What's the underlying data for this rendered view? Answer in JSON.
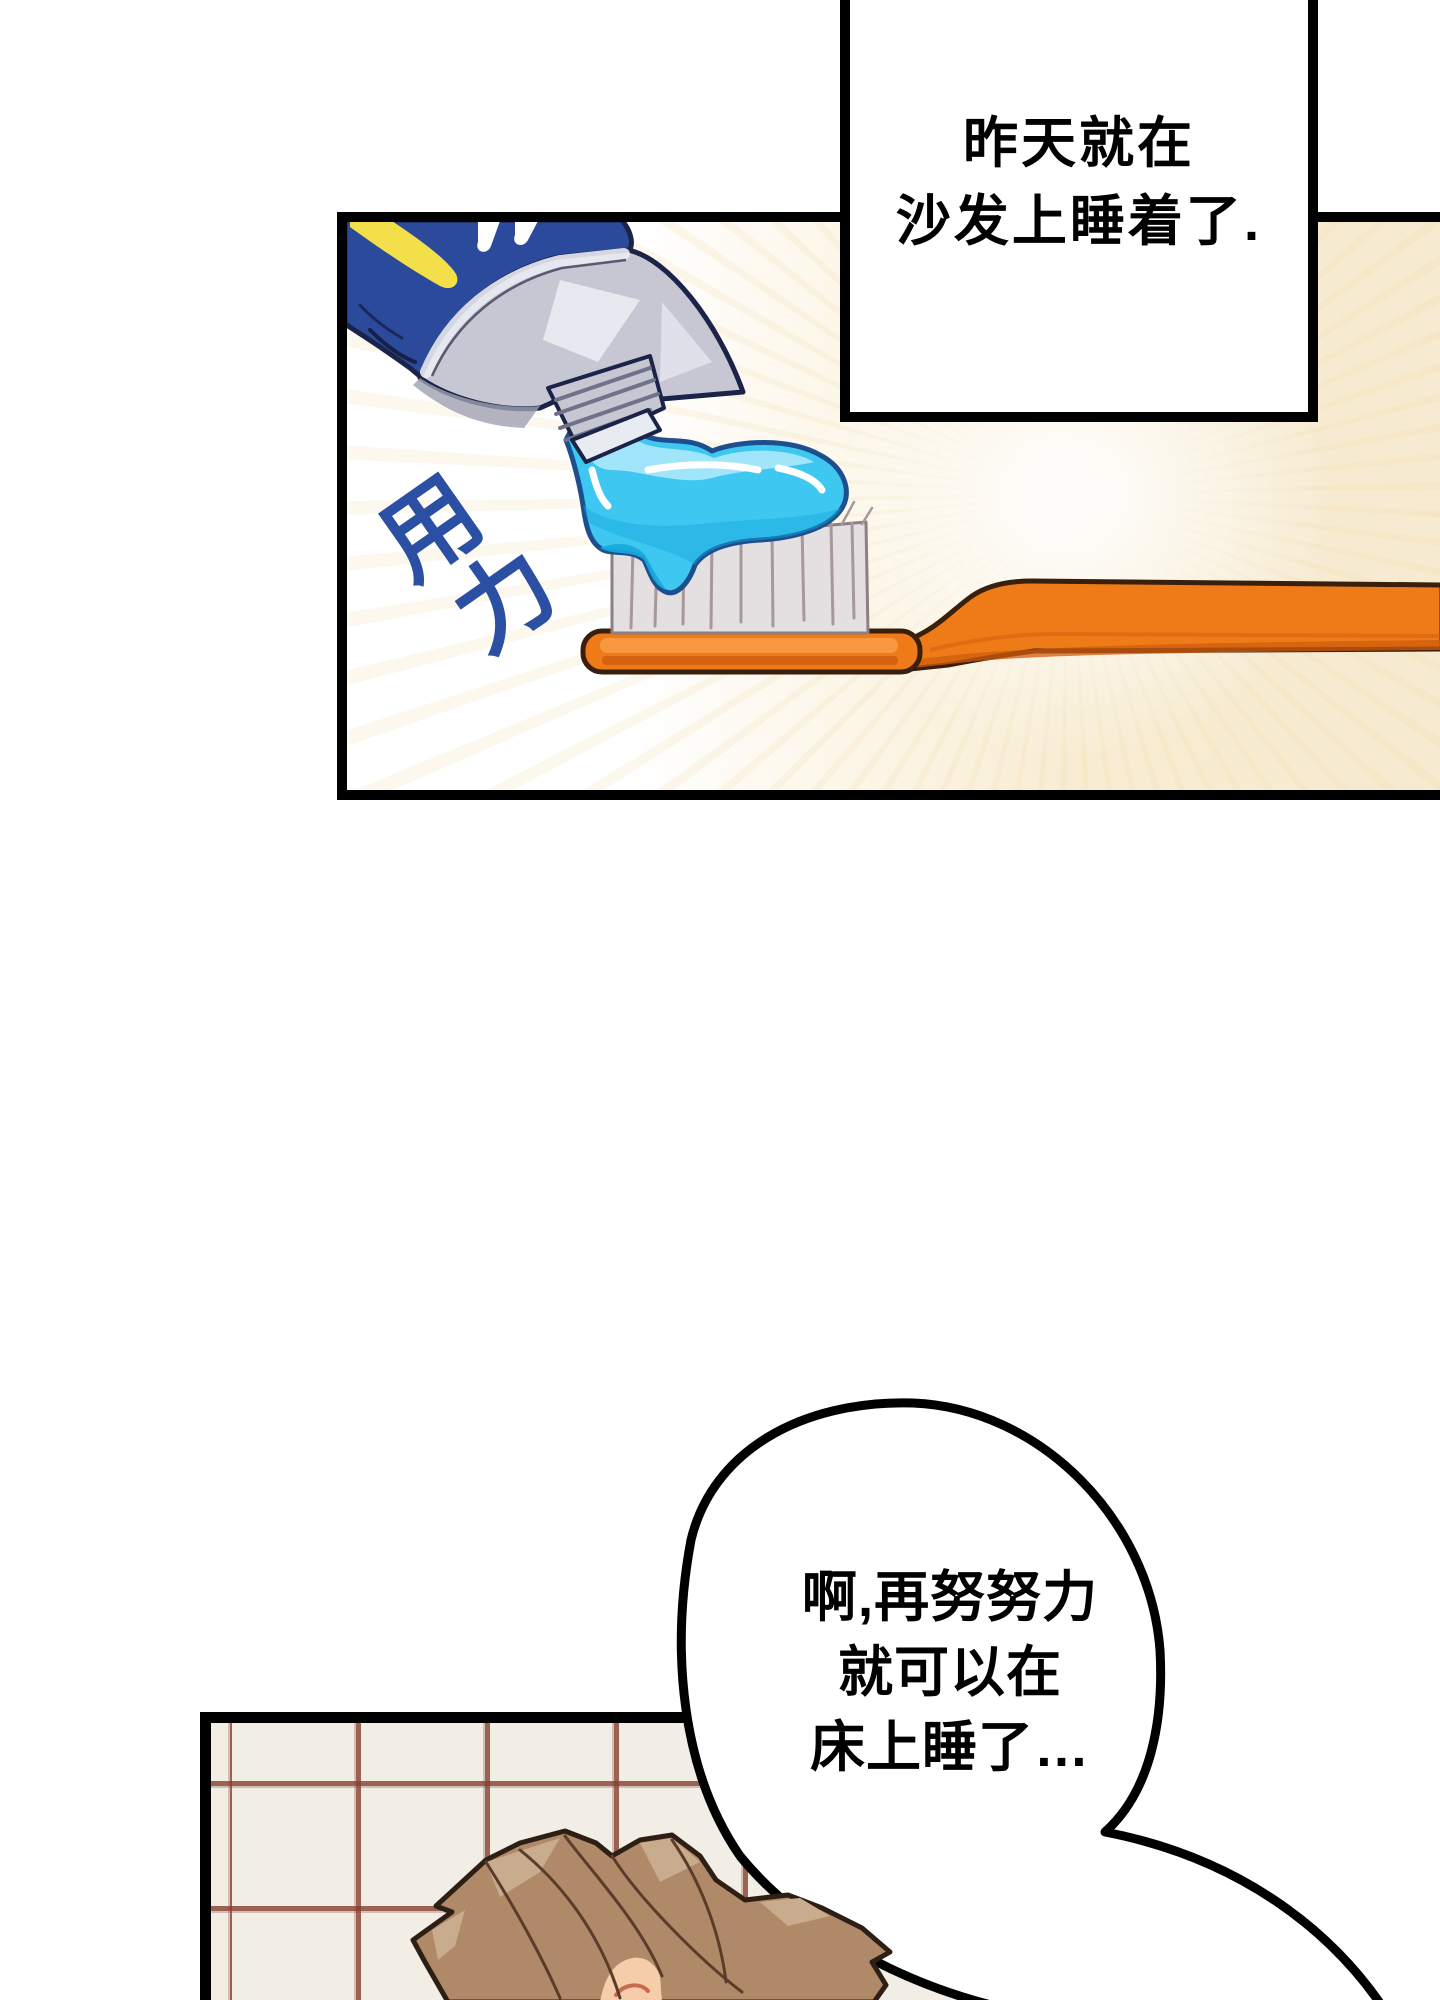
{
  "panel1": {
    "bubble": {
      "lines": [
        "昨天就在",
        "沙发上睡着了."
      ]
    },
    "sfx": {
      "chars": [
        "用",
        "力"
      ]
    },
    "objects": [
      "toothpaste-tube",
      "toothpaste-squeeze",
      "toothbrush"
    ]
  },
  "panel2": {
    "balloon": {
      "lines": [
        "啊,再努努力",
        "就可以在",
        "床上睡了…"
      ]
    },
    "objects": [
      "tiled-wall",
      "character-brown-hair"
    ]
  },
  "colors": {
    "page-bg": "#ffffff",
    "ink": "#000000",
    "panel-cream": "#f8edd3",
    "tube-blue": "#2b4a9c",
    "tube-outline": "#1b2448",
    "stripe-yellow": "#f3df49",
    "silver": "#c6c7d2",
    "silver-light": "#e9ebf2",
    "silver-dark": "#9fa1b3",
    "paste-cyan": "#3ec7f1",
    "paste-cyan-dark": "#17a8dc",
    "paste-cyan-light": "#a6e7fa",
    "paste-outline": "#1d4f8f",
    "brush-orange": "#ee7b17",
    "brush-orange-light": "#f79a42",
    "brush-orange-dark": "#cf5c0d",
    "brush-outline": "#3a1f0d",
    "bristle": "#e4dfe0",
    "bristle-line": "#a6989b",
    "sfx-blue": "#2b4fa3",
    "tile-bg": "#f2eee6",
    "tile-line": "#96493a",
    "hair": "#b08968",
    "hair-light": "#c9ab8e",
    "hair-line": "#5a3c2a",
    "hair-outline": "#2e1f15",
    "skin": "#f6cdaa",
    "brow": "#c96b4e"
  }
}
